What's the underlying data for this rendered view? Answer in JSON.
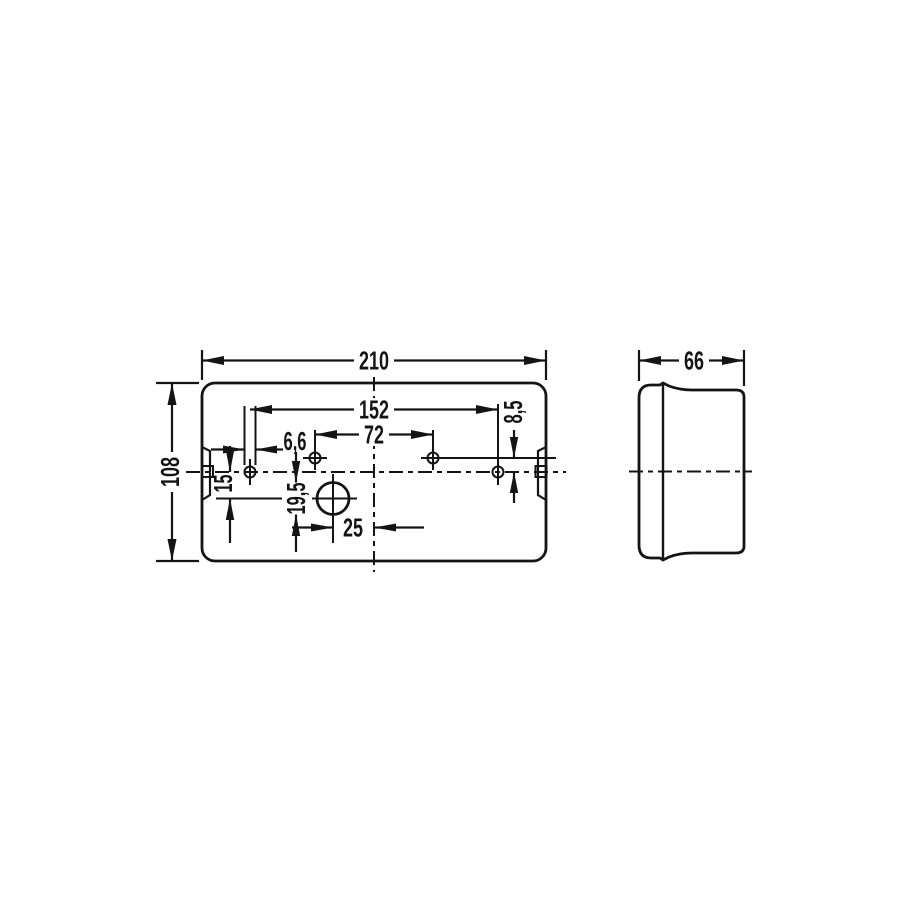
{
  "drawing": {
    "type": "technical-dimension-drawing",
    "subject": "rectangular lamp housing, front view and side view",
    "units": "mm",
    "colors": {
      "line": "#141414",
      "background": "#ffffff"
    },
    "labels": {
      "width": "210",
      "height": "108",
      "mount_span": "152",
      "upper_span": "72",
      "hole_dia": "6,6",
      "upper_offset": "8,5",
      "circle_offset_v": "15",
      "circle_dia": "19,5",
      "circle_offset_h": "25",
      "depth": "66"
    }
  }
}
